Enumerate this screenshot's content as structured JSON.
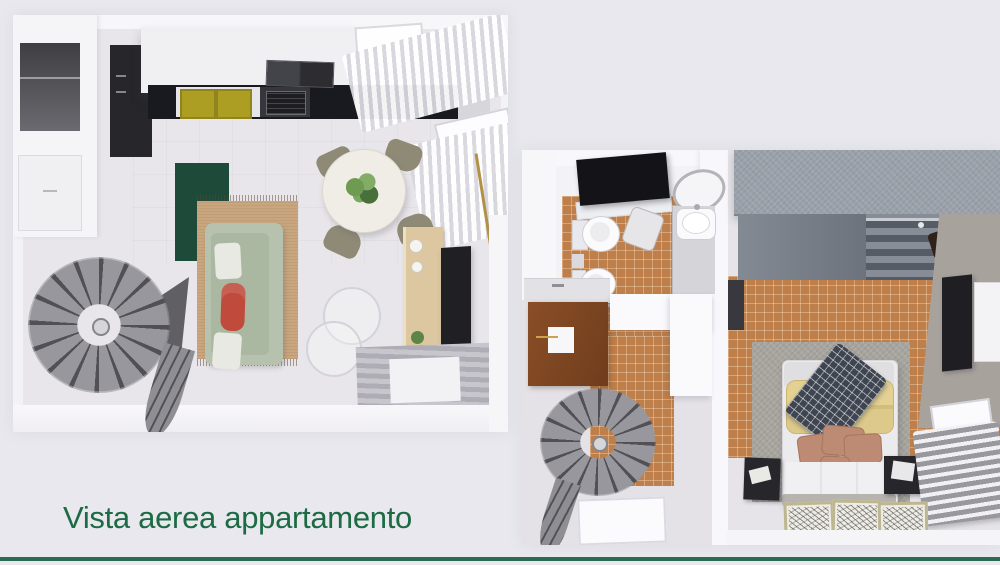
{
  "caption": {
    "text": "Vista aerea appartamento"
  },
  "palette": {
    "page_bg": "#E8E8EE",
    "caption_green": "#1C6B43",
    "divider_green": "#2E6B4E",
    "tile_terracotta": "#BE7F4A",
    "rug_green": "#1D4A39",
    "rug_jute": "#C9A67E",
    "sofa_sage": "#B6C2AD",
    "pillow_red": "#C04A3B",
    "pillow_yellow": "#E3D092",
    "cushion_salmon": "#BD8A74",
    "wardrobe_gray": "#9AA1AA",
    "counter_black": "#191920"
  },
  "scene": {
    "left_view": {
      "name": "living-room-and-kitchen-aerial-render",
      "objects": [
        "wall-niches",
        "kitchen-hood",
        "kitchen-counter",
        "kitchen-sinks",
        "cutting-boards",
        "stove",
        "window-curtains",
        "skylight",
        "dining-table",
        "table-plant",
        "dining-chairs",
        "green-rug",
        "jute-rug",
        "sofa",
        "red-pillow",
        "wireframe-chairs",
        "sideboard",
        "tv",
        "striped-rug",
        "spiral-staircase"
      ]
    },
    "right_view": {
      "name": "bathroom-hallway-and-bedroom-aerial-render",
      "objects": [
        "shower",
        "mirror",
        "washbasin",
        "vanity",
        "laundry-stool",
        "toilet",
        "bidet",
        "towel-rails",
        "tiled-floor",
        "entry-door",
        "partition-wall",
        "spiral-staircase",
        "floor-skylight",
        "wardrobe",
        "hanging-clothes",
        "bed",
        "yellow-pillows",
        "plaid-blanket",
        "salmon-cushions",
        "duvet",
        "nightstands",
        "table-lamp",
        "radiator",
        "window",
        "tv",
        "wall-cabinet",
        "picture-frames"
      ]
    }
  }
}
